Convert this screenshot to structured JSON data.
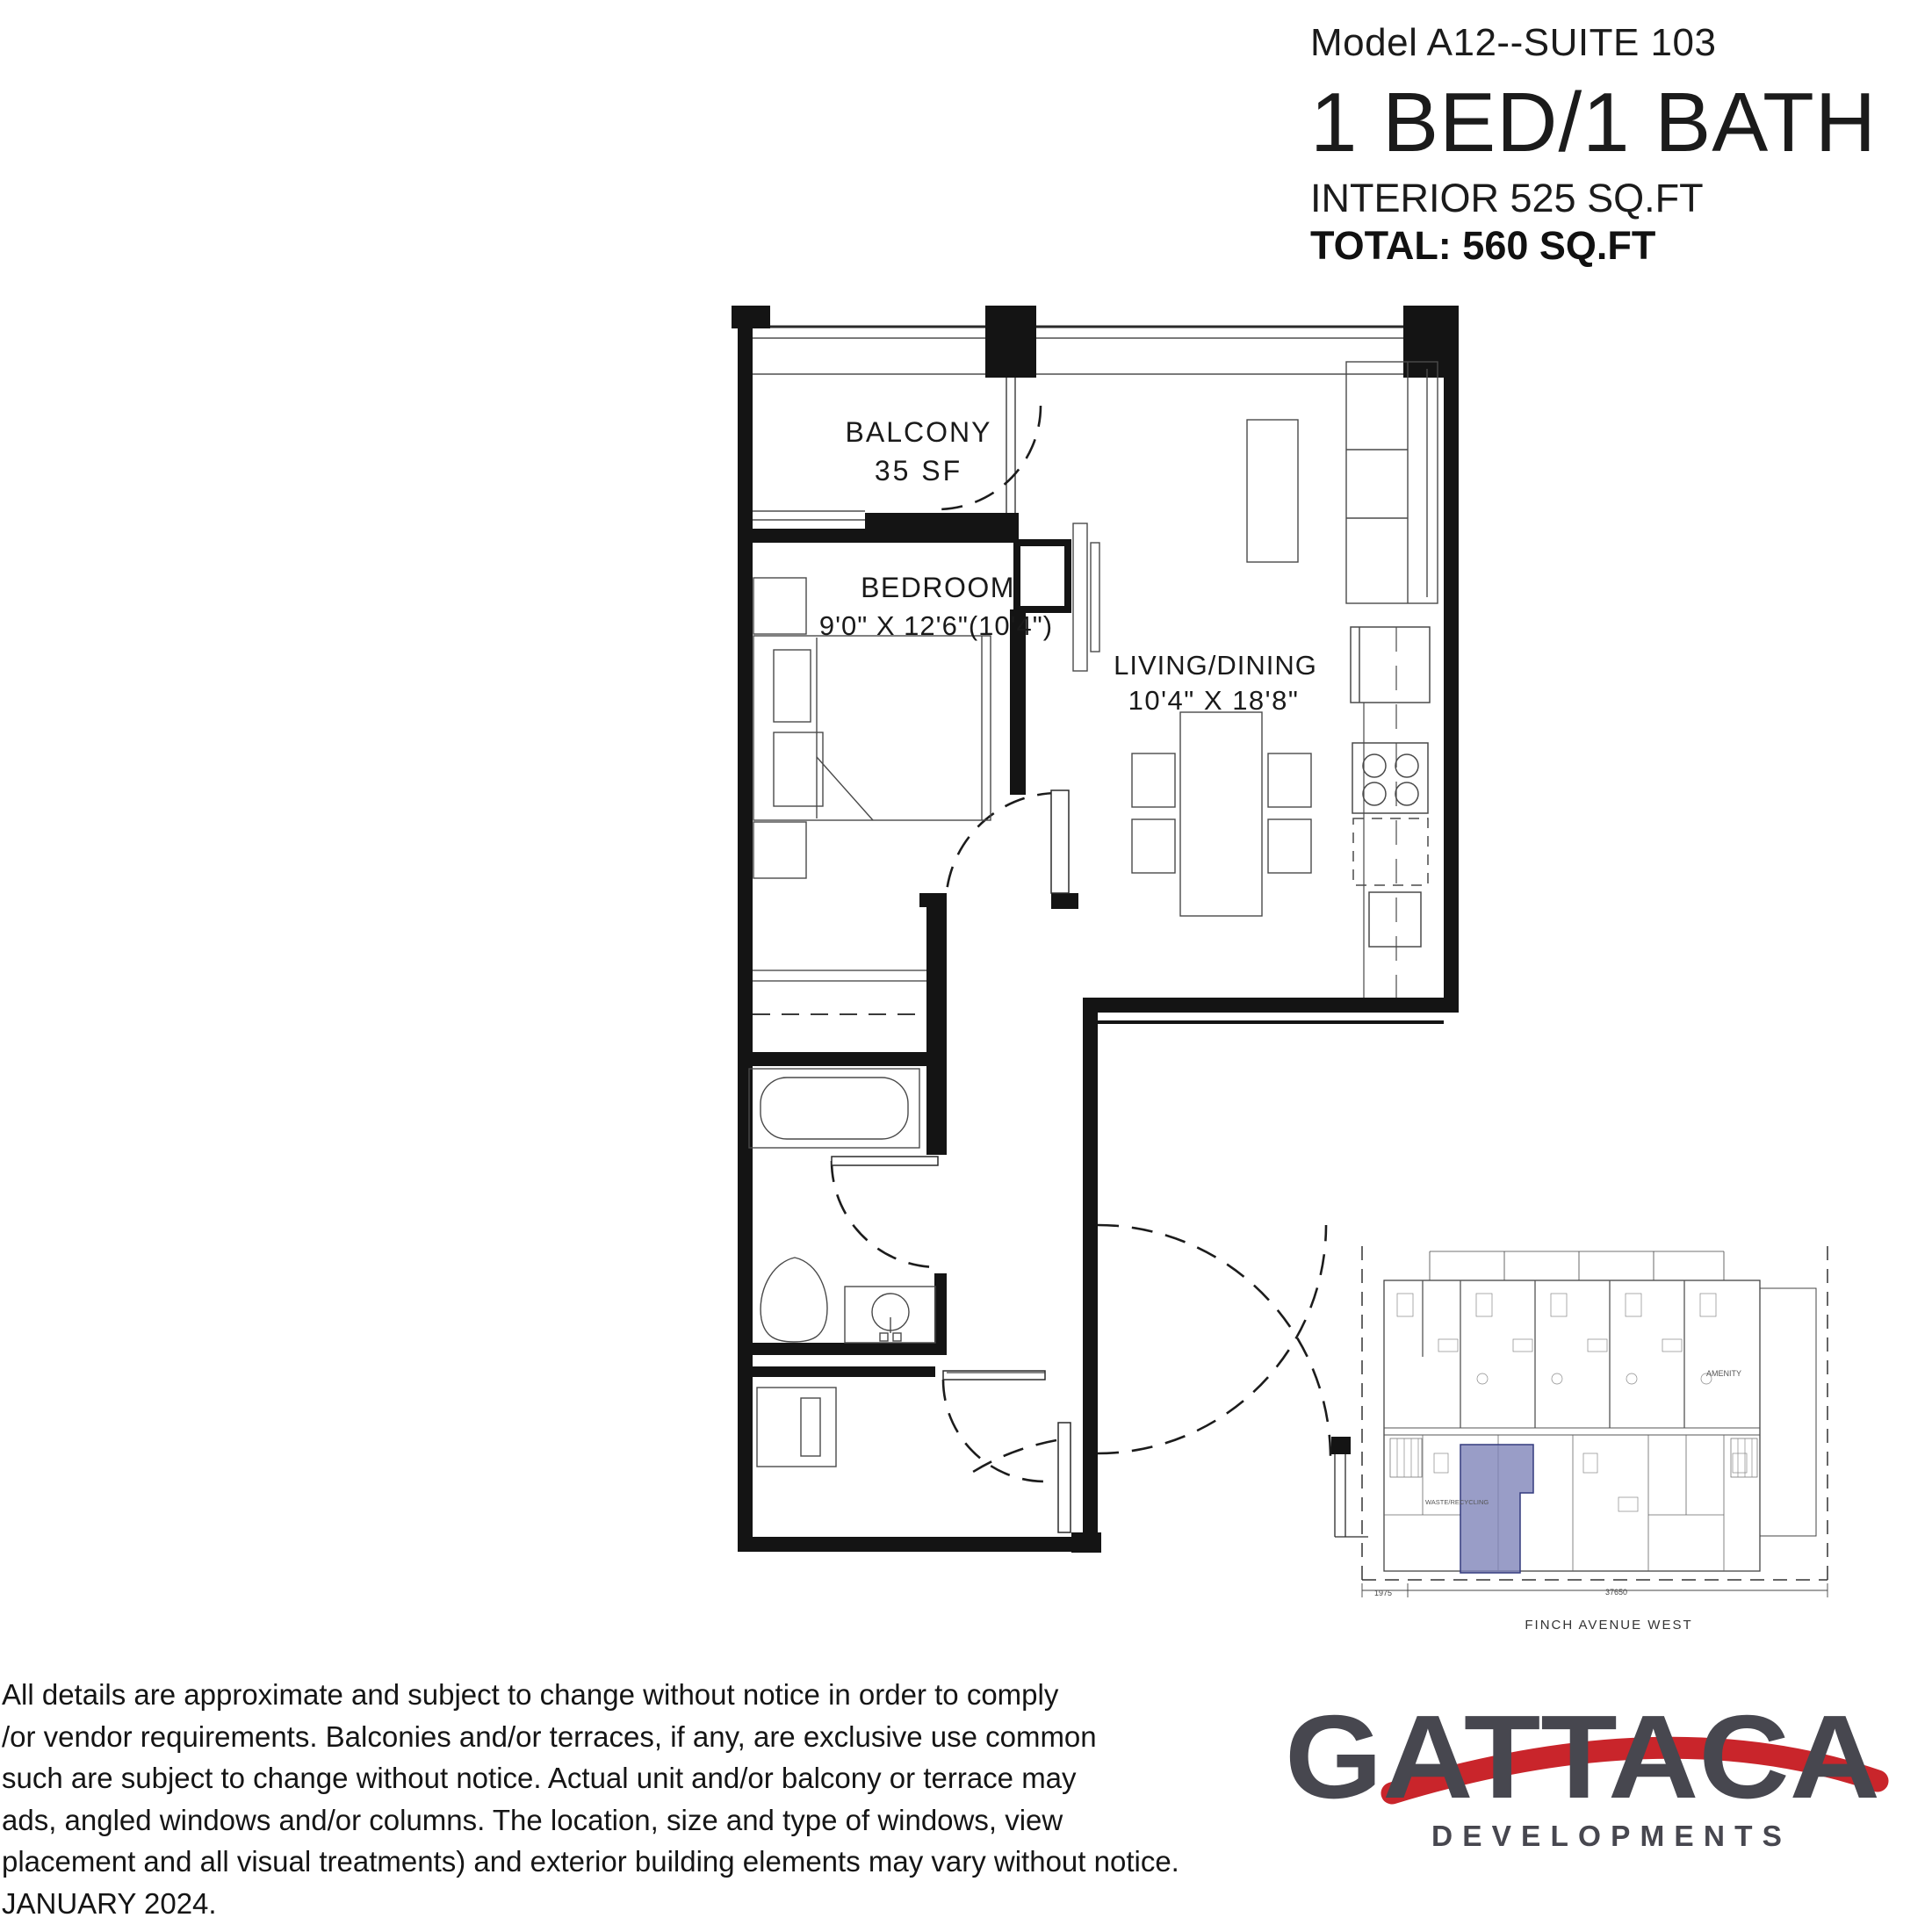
{
  "header": {
    "model": "Model A12--SUITE 103",
    "title": "1 BED/1 BATH",
    "interior": "INTERIOR 525 SQ.FT",
    "total": "TOTAL: 560 SQ.FT"
  },
  "plan": {
    "balcony_label": "BALCONY",
    "balcony_area": "35 SF",
    "bedroom_label": "BEDROOM",
    "bedroom_dims": "9'0\" X 12'6\"(10'4\")",
    "living_label": "LIVING/DINING",
    "living_dims": "10'4\" X 18'8\""
  },
  "keyplan": {
    "street": "FINCH AVENUE WEST",
    "amenity": "AMENITY",
    "waste": "WASTE/RECYCLING",
    "dim_left": "1975",
    "dim_width": "37650",
    "highlight_color": "#7f84b9"
  },
  "logo": {
    "name": "GATTACA",
    "tagline": "DEVELOPMENTS",
    "accent_color": "#c9252b",
    "text_color": "#47474f"
  },
  "disclaimer": {
    "lines": [
      "All details are approximate and subject to change without notice in order to comply",
      "/or vendor requirements. Balconies and/or terraces, if any, are exclusive use common",
      "such are subject to change without notice.  Actual unit and/or balcony or terrace may",
      "ads, angled windows and/or columns.  The location, size and type of windows, view",
      "placement and all visual treatments) and exterior building elements may vary without notice.",
      "JANUARY 2024."
    ]
  }
}
